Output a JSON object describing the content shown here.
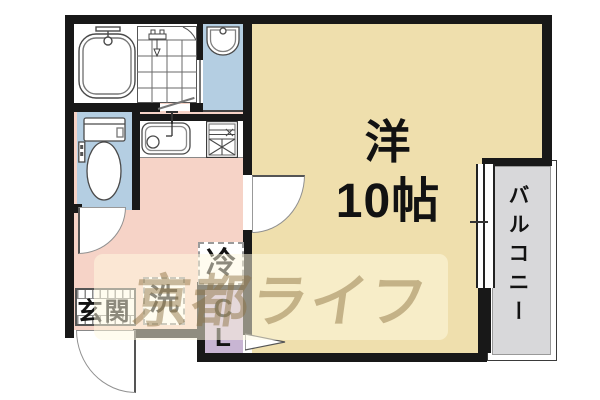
{
  "plan": {
    "main_room": {
      "label_line1": "洋",
      "label_line2": "10帖"
    },
    "balcony": {
      "label": "バルコニー"
    },
    "entrance": {
      "label": "玄関"
    },
    "closet": {
      "label_line1": "C",
      "label_line2": "L"
    },
    "washer": {
      "label": "洗"
    },
    "fridge": {
      "label": "冷"
    },
    "watermark": {
      "text": "京都ライフ"
    }
  },
  "colors": {
    "wall": "#181818",
    "main_room_floor": "#EFDFAD",
    "hall_kitchen_floor": "#F6D3C7",
    "wet_room_floor": "#B4CEE2",
    "closet_floor": "#C8B5D3",
    "balcony_floor": "#D8D8DA",
    "watermark_text": "#8C7140"
  }
}
